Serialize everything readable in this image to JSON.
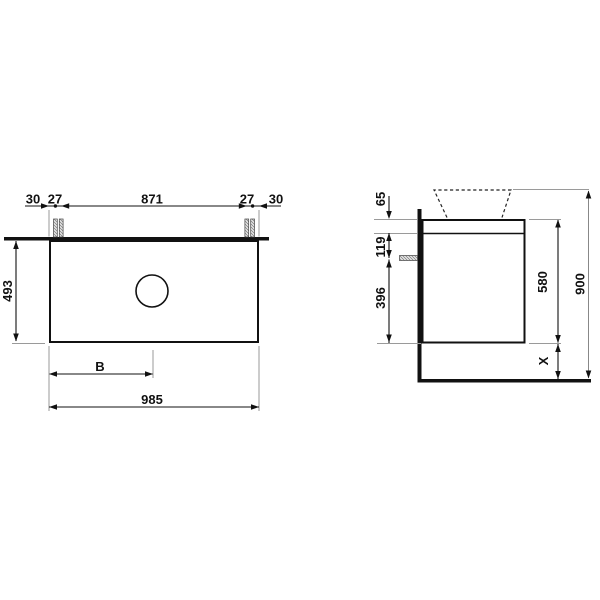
{
  "plan": {
    "top_chain": [
      "30",
      "27",
      "871",
      "27",
      "30"
    ],
    "depth": "493",
    "basin_offset": "B",
    "width": "985"
  },
  "side": {
    "plate_thickness": "65",
    "bracket_offset": "119",
    "lower_height": "396",
    "cabinet_height": "580",
    "clearance": "X",
    "total_height": "900"
  },
  "colors": {
    "line": "#111111",
    "extension": "#9a9a9a",
    "background": "#ffffff"
  }
}
